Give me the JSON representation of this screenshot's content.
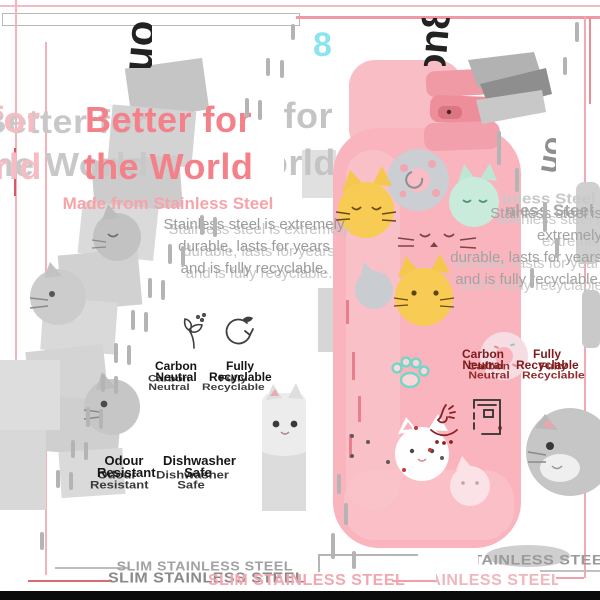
{
  "brand": {
    "name": "ion8",
    "mark": "8"
  },
  "title": {
    "line1": "Better for",
    "line2": "the World"
  },
  "subtitle": "Made from Stainless Steel",
  "body": {
    "line1": "Stainless steel is extremely",
    "line2": "durable, lasts for years",
    "line3": "and is fully recyclable."
  },
  "features": [
    {
      "label": "Carbon Neutral",
      "icon": "dandelion-seeds-icon"
    },
    {
      "label": "Fully Recyclable",
      "icon": "recycle-arrows-icon"
    },
    {
      "label": "Odour Resistant",
      "icon": "nose-scent-icon"
    },
    {
      "label": "Dishwasher Safe",
      "icon": "dishwasher-icon"
    }
  ],
  "banner": "SLIM STAINLESS STEEL",
  "colors": {
    "title_pink": "#f4808a",
    "subtitle_pink": "#f7a3aa",
    "body_grey": "#9b9b9b",
    "bottle_pink": "#f9b4be",
    "cap_deep_pink": "#ee8e9a",
    "lid_grey": "#b2b2b2",
    "accent_cyan": "#8ce4ef",
    "label_black": "#141414",
    "label_dark_red": "#7c1c1c",
    "banner_pink": "#f3a7b0",
    "banner_grey": "#9e9e9e",
    "frame_pink": "#f2a9b2",
    "ghost_grey": "#d6d6d6",
    "cat_yellow": "#f8cb55",
    "cat_mint": "#c8ebdc",
    "paw_teal": "#74d6c6",
    "bottom_bar": "#0b0b0b"
  }
}
